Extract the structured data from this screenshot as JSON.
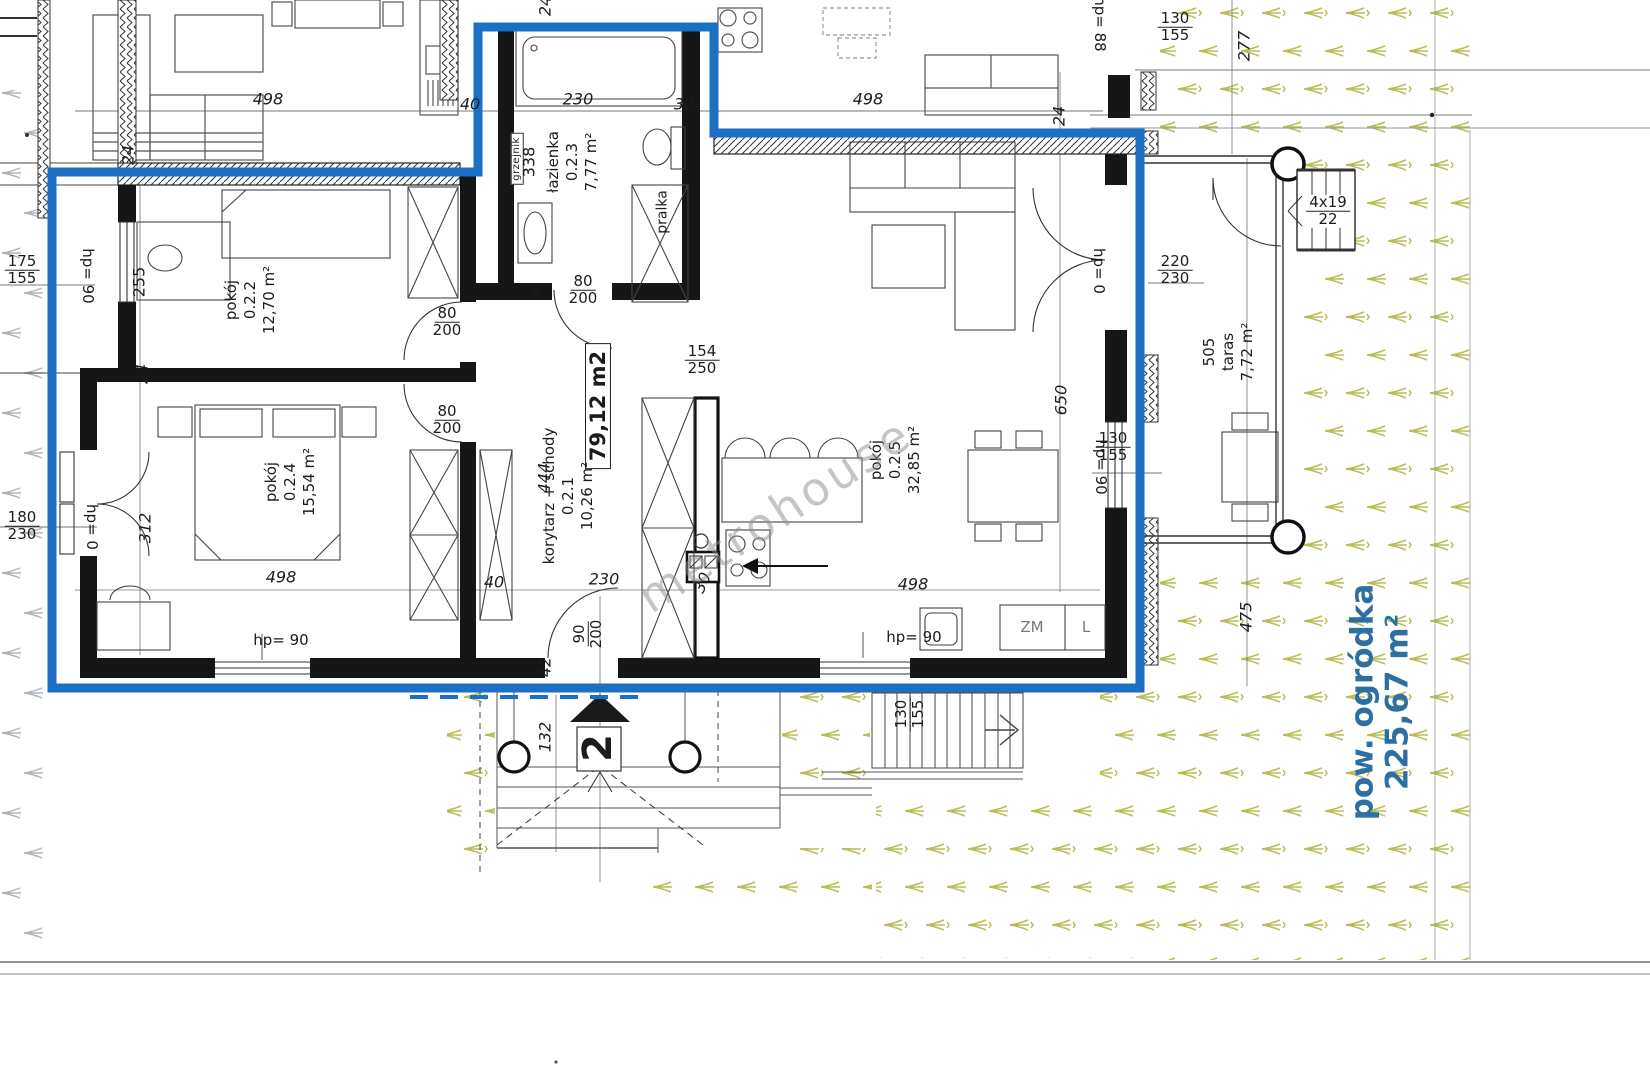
{
  "plan": {
    "unit_marker": "2",
    "watermark": "metrohouse",
    "area_box": "79,12 m2",
    "garden_label": {
      "line1": "pow. ogródka",
      "line2": "225,67 m²"
    },
    "rooms": {
      "r021": {
        "name": "korytarz + schody",
        "no": "0.2.1",
        "area": "10,26 m²"
      },
      "r022": {
        "name": "pokój",
        "no": "0.2.2",
        "area": "12,70 m²"
      },
      "r023": {
        "name": "łazienka",
        "no": "0.2.3",
        "area": "7,77 m²"
      },
      "r024": {
        "name": "pokój",
        "no": "0.2.4",
        "area": "15,54 m²"
      },
      "r025": {
        "name": "pokój",
        "no": "0.2.5",
        "area": "32,85 m²"
      },
      "taras": {
        "dim": "505",
        "name": "taras",
        "area": "7,72 m²"
      }
    },
    "fixtures": {
      "pralka": "pralka",
      "grzejnik": "grzejnik",
      "zm": "ZM",
      "l": "L"
    },
    "dims": {
      "d498": "498",
      "d40": "40",
      "d230": "230",
      "d30": "30",
      "d24": "24",
      "d255": "255",
      "d338": "338",
      "d312": "312",
      "d444": "444",
      "d650": "650",
      "d277": "277",
      "d475": "475",
      "d132": "132",
      "d42": "42",
      "d8": "8",
      "hp90": "hp= 90",
      "hp0": "hp= 0",
      "hp88": "hp= 88",
      "f175_155": {
        "top": "175",
        "bot": "155"
      },
      "f180_230": {
        "top": "180",
        "bot": "230"
      },
      "f80_200": {
        "top": "80",
        "bot": "200"
      },
      "f90_200": {
        "top": "90",
        "bot": "200"
      },
      "f154_250": {
        "top": "154",
        "bot": "250"
      },
      "f130_155": {
        "top": "130",
        "bot": "155"
      },
      "f220_230": {
        "top": "220",
        "bot": "230"
      },
      "f4x19_22": {
        "top": "4x19",
        "bot": "22"
      }
    },
    "colors": {
      "boundary_blue": "#1b6fc4",
      "plant_olive": "#b9bd55",
      "garden_text_blue": "#2e6fa3"
    }
  }
}
